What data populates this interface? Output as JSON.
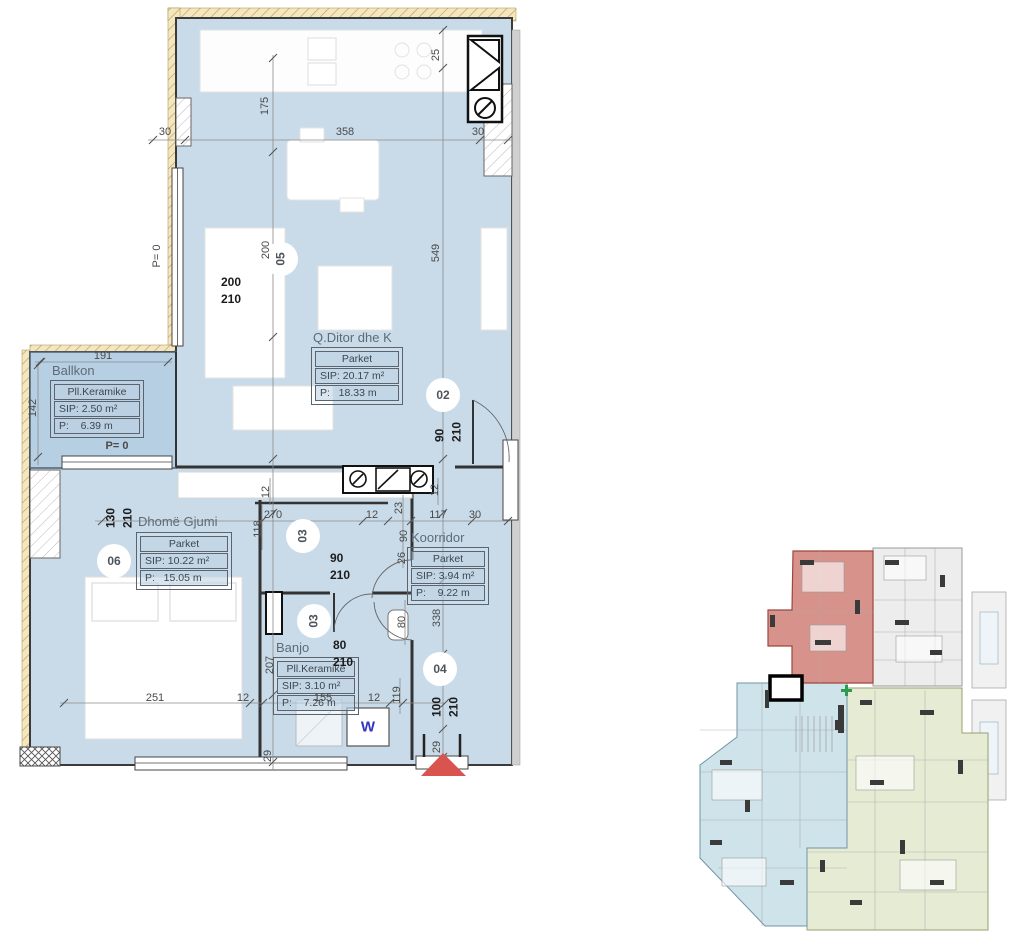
{
  "palette": {
    "room_fill": "#c9dbe9",
    "balcony_fill": "#b7cfe2",
    "wall_hatch": "#e9d7a2",
    "dim_text": "#4a4a4a",
    "entrance_marker": "#d9534f",
    "washer_text": "#3434bf",
    "overview_highlight": "#d1837b",
    "overview_blue": "#cfe3ea",
    "overview_green": "#e6ecd4",
    "overview_gray": "#ededed"
  },
  "rooms": {
    "ballkon": {
      "name": "Ballkon",
      "floor": "Pll.Keramike",
      "sip": "SIP: 2.50 m²",
      "p": "P:    6.39 m"
    },
    "living": {
      "name": "Q.Ditor dhe K",
      "floor": "Parket",
      "sip": "SIP: 20.17 m²",
      "p": "P:   18.33 m"
    },
    "bedroom": {
      "name": "Dhomë Gjumi",
      "floor": "Parket",
      "sip": "SIP: 10.22 m²",
      "p": "P:   15.05 m"
    },
    "corridor": {
      "name": "Koorridor",
      "floor": "Parket",
      "sip": "SIP: 3.94 m²",
      "p": "P:    9.22 m"
    },
    "bath": {
      "name": "Banjo",
      "floor": "Pll.Keramike",
      "sip": "SIP: 3.10 m²",
      "p": "P:    7.26 m"
    }
  },
  "tags": {
    "t02": "02",
    "t03": "03",
    "t04": "04",
    "t05": "05",
    "t06": "06"
  },
  "door_sizes": {
    "s200": [
      "200",
      "210"
    ],
    "s90": [
      "90",
      "210"
    ],
    "s80": [
      "80",
      "210"
    ],
    "s100": [
      "100",
      "210"
    ],
    "s130": [
      "130",
      "210"
    ]
  },
  "dims": {
    "v12": "12",
    "v23": "23",
    "v25": "25",
    "v26": "26",
    "v29": "29",
    "v30": "30",
    "v80": "80",
    "v90": "90",
    "v117": "117",
    "v118": "118",
    "v119": "119",
    "v142": "142",
    "v155": "155",
    "v175": "175",
    "v191": "191",
    "v200": "200",
    "v207": "207",
    "v251": "251",
    "v270": "270",
    "v338": "338",
    "v358": "358",
    "v549": "549"
  },
  "annotations": {
    "p_zero": "P= 0",
    "washer": "W"
  }
}
